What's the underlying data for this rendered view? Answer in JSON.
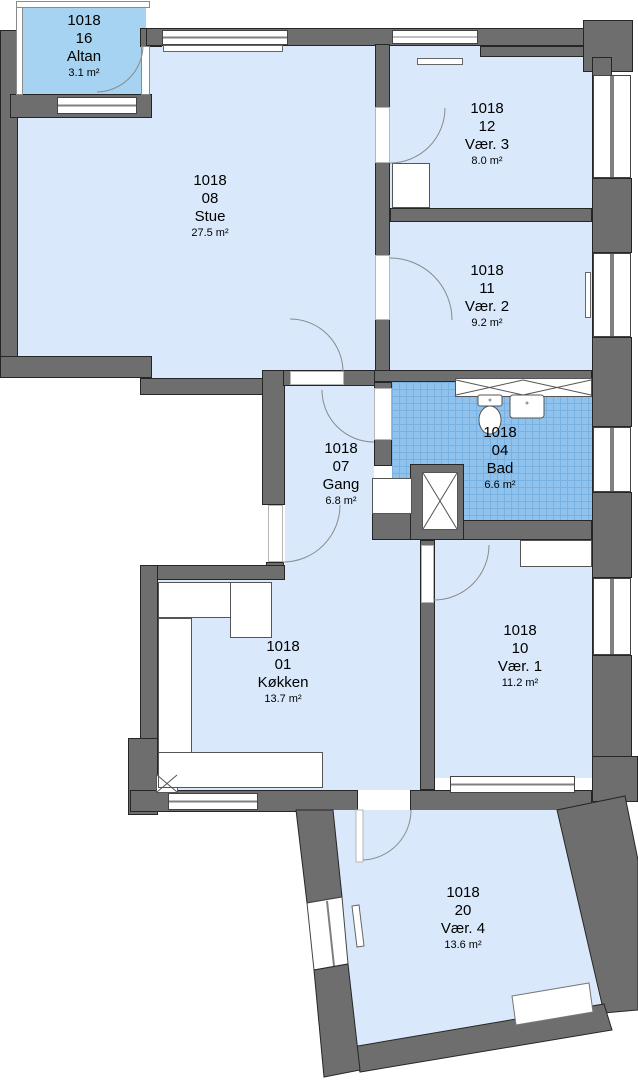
{
  "plan_title": "Floor plan unit 1018",
  "colors": {
    "wall": "#6e6e6e",
    "wall_outline": "#262626",
    "room_fill": "#d9e9fb",
    "balcony_fill": "#a6d3f2",
    "bathroom_tile": "#8fc3ee",
    "bathroom_grid": "#79b2e0",
    "fixture_white": "#ffffff",
    "text": "#000000"
  },
  "rooms": [
    {
      "key": "altan",
      "id": "1018",
      "number": "16",
      "name": "Altan",
      "area": "3.1 m²"
    },
    {
      "key": "stue",
      "id": "1018",
      "number": "08",
      "name": "Stue",
      "area": "27.5 m²"
    },
    {
      "key": "vaer3",
      "id": "1018",
      "number": "12",
      "name": "Vær. 3",
      "area": "8.0 m²"
    },
    {
      "key": "vaer2",
      "id": "1018",
      "number": "11",
      "name": "Vær. 2",
      "area": "9.2 m²"
    },
    {
      "key": "gang",
      "id": "1018",
      "number": "07",
      "name": "Gang",
      "area": "6.8 m²"
    },
    {
      "key": "bad",
      "id": "1018",
      "number": "04",
      "name": "Bad",
      "area": "6.6 m²"
    },
    {
      "key": "kokken",
      "id": "1018",
      "number": "01",
      "name": "Køkken",
      "area": "13.7 m²"
    },
    {
      "key": "vaer1",
      "id": "1018",
      "number": "10",
      "name": "Vær. 1",
      "area": "11.2 m²"
    },
    {
      "key": "vaer4",
      "id": "1018",
      "number": "20",
      "name": "Vær. 4",
      "area": "13.6 m²"
    }
  ]
}
